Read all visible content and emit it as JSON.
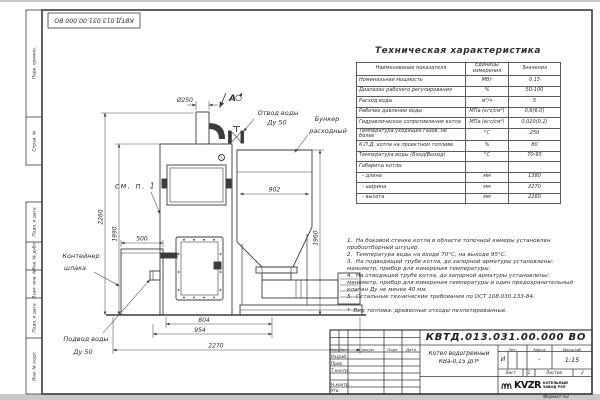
{
  "sheet": {
    "designation": "КВТД.013.031.00.000 ВО",
    "format_label": "Формат А3",
    "stamps": {
      "perv": "Перв. примен.",
      "sprav": "Справ. №",
      "podp1": "Подп. и дата",
      "inv_dubl": "Инв. № дубл.",
      "vzam": "Взам. инв. №",
      "podp2": "Подп. и дата",
      "inv_podl": "Инв. № подл."
    }
  },
  "tech_table": {
    "title": "Техническая характеристика",
    "headers": [
      "Наименование показателя",
      "Единицы\nизмерения",
      "Значения"
    ],
    "rows": [
      [
        "Номинальная мощность",
        "МВт",
        "0,15"
      ],
      [
        "Диапазон рабочего регулирования",
        "%",
        "50-100"
      ],
      [
        "Расход воды",
        "м³/ч",
        "5"
      ],
      [
        "Рабочее давление воды",
        "МПа (кгс/см²)",
        "0,6(6,0)"
      ],
      [
        "Гидравлическое сопротивление котла",
        "МПа (кгс/см²)",
        "0,020(0,2)"
      ],
      [
        "Температура уходящих газов, не более",
        "°С",
        "250"
      ],
      [
        "К.П.Д. котла на проектном топливе",
        "%",
        "80"
      ],
      [
        "Температура воды (Вход/Выход)",
        "°С",
        "70-95"
      ],
      [
        "Габариты котла:",
        "",
        ""
      ],
      [
        "  - длина",
        "мм",
        "1380"
      ],
      [
        "  - ширина",
        "мм",
        "2270"
      ],
      [
        "  - высота",
        "мм",
        "2260"
      ]
    ]
  },
  "notes": {
    "lines": [
      "1.  На боковой стенке котла в области топочной камеры установлен",
      "пробоотборный штуцер.",
      "2.  Температура воды на входе 70°С, на выходе 95°С.",
      "3.  На подводящей трубе котла, до запорной арматуры установлены:",
      "манометр, прибор для измерения температуры.",
      "4.  На отводящей трубе котла, до запорной арматуры установлены:",
      "манометр, прибор для измерения температуры и один предохранительный",
      "клапан Ду не менее 40 мм.",
      "5.  Остальные технические требования по ОСТ 108.030.133-84.",
      "",
      "*  Вид топлива: древесные отходы пеллетированные."
    ]
  },
  "drawing": {
    "labels": {
      "view_label": "А",
      "outlet_line1": "Отвод воды",
      "outlet_line2": "Ду 50",
      "hopper_line1": "Бункер",
      "hopper_line2": "расходный",
      "see_note": "см. п. 1",
      "container_line1": "Контейнер",
      "container_line2": "шлака",
      "inlet_line1": "Подвод воды",
      "inlet_line2": "Ду 50"
    },
    "dimensions": {
      "chimney": "Ø250",
      "bunker_width": "902",
      "height_total": "2260",
      "height_boiler": "1990",
      "container_width": "500",
      "height_bunker": "1960",
      "width_804": "804",
      "width_954": "954",
      "width_total": "2270"
    }
  },
  "title_block": {
    "designation": "КВТД.013.031.00.000  ВО",
    "col_izm": "Изм.",
    "col_list": "Лист",
    "col_doc": "N докум.",
    "col_podp": "Подп.",
    "col_data": "Дата",
    "row_razrab": "Разраб.",
    "row_prov": "Пров.",
    "row_tkontr": "Т.контр.",
    "row_nkontr": "Н.контр.",
    "row_utv": "Утв.",
    "title_line1": "Котел водогрейный",
    "title_line2": "КВа-0,15  ДП*",
    "lit_h": "Лит.",
    "mass_h": "Масса",
    "scale_h": "Масштаб",
    "lit_v": "И",
    "mass_v": "-",
    "scale_v": "1:15",
    "sheet_h": "Лист",
    "sheet_v": "1",
    "sheets_h": "Листов",
    "sheets_v": "2",
    "logo": "KVZR",
    "logo_line1": "КОТЕЛЬНЫЙ",
    "logo_line2": "ЗАВОД РЭП"
  }
}
